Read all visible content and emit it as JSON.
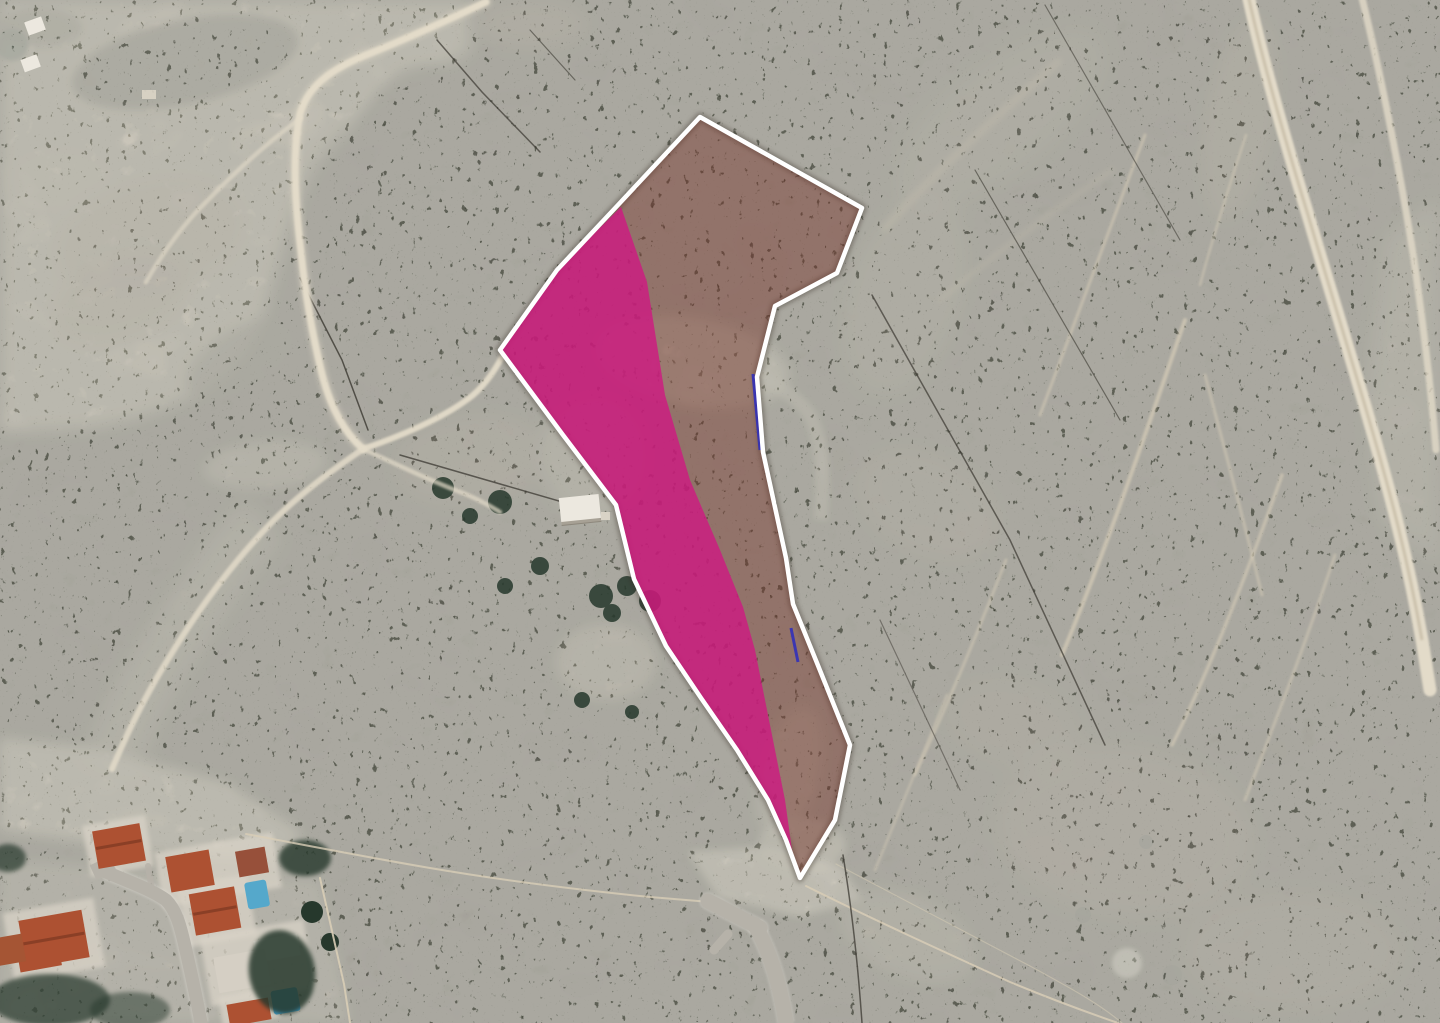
{
  "view": {
    "type": "satellite-aerial-imagery",
    "width_px": 1440,
    "height_px": 1023,
    "scene": "hillside scrubland with outlined land parcel, magenta highlighted sub-area, dirt tracks and residential corner at bottom-left"
  },
  "colors": {
    "parcel_outline": "#ffffff",
    "parcel_tint": "rgba(118,52,40,0.45)",
    "parcel_highlight": "rgba(208,24,130,0.80)",
    "cadastral_line": "#2c2cbe",
    "terrain_base": "#37342c",
    "terrain_sand": "#cfc3ad",
    "dirt_road": "#e3dbc9",
    "asphalt_road": "#b6b2a9",
    "roof_terracotta": "#ad5132",
    "roof_white": "#d8d3c9",
    "pool_water": "#55a8cb",
    "vegetation_dark": "#26382c",
    "fence_light": "#d8cdb6",
    "fence_dark": "#3b3831",
    "building_white": "#ece8df"
  },
  "parcel": {
    "outline_points": "700,117 862,208 837,273 775,306 757,377 763,452 786,558 793,604 817,663 850,745 835,820 800,878 786,840 768,800 737,750 701,698 666,646 634,579 616,505 563,435 500,350 557,270 618,205",
    "highlight_points": "621,207 647,282 665,395 690,480 720,550 743,607 755,650 765,700 775,750 785,800 792,850 798,868 800,878 786,840 768,800 737,750 701,698 666,646 634,579 616,505 563,435 500,350 557,270",
    "cadastral_segment_a": "753,374 760,450",
    "cadastral_segment_b": "791,628 798,662"
  }
}
